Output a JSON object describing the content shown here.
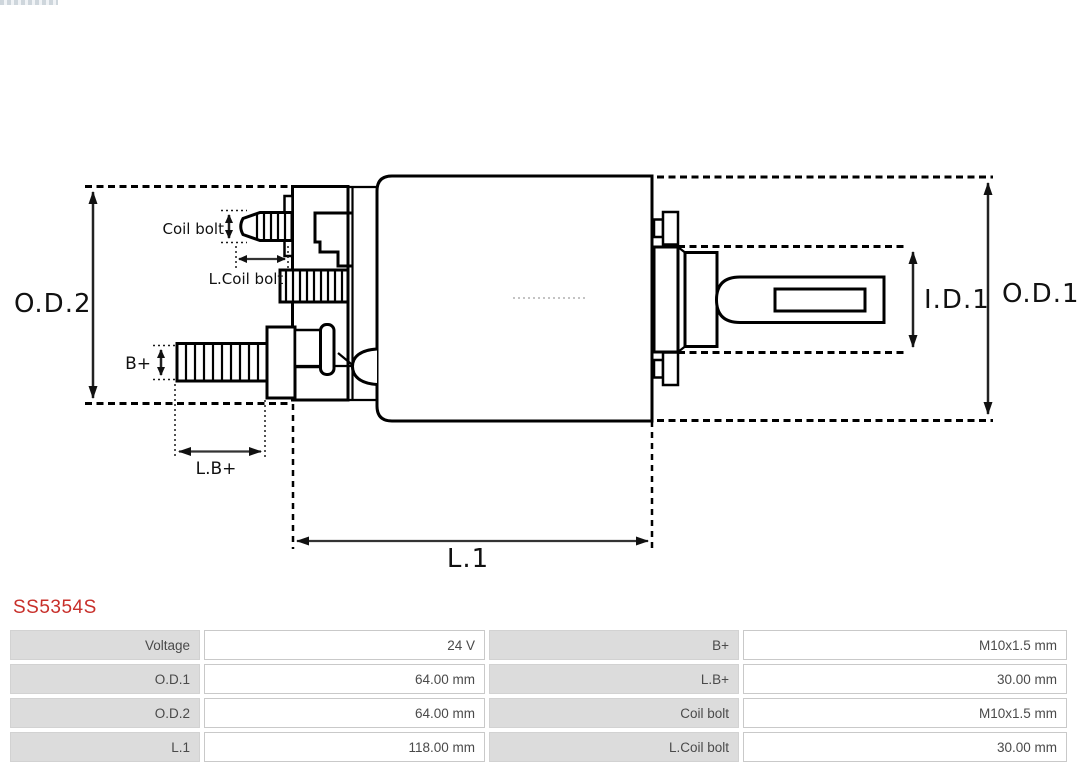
{
  "header": {
    "part_number": "SS5354S",
    "part_number_color": "#c8302b"
  },
  "diagram": {
    "type": "technical-drawing",
    "labels": {
      "od2": "O.D.2",
      "od1": "O.D.1",
      "id1": "I.D.1",
      "l1": "L.1",
      "coil_bolt": "Coil bolt",
      "l_coil_bolt": "L.Coil bolt",
      "b_plus": "B+",
      "l_b_plus": "L.B+"
    },
    "line_color": "#000000",
    "dim_line_color": "#333333"
  },
  "specs": {
    "label_bg": "#dcdcdc",
    "border_color": "#c9c9c9",
    "text_color": "#4a4a4a",
    "rows": [
      {
        "cells": [
          "Voltage",
          "24 V",
          "B+",
          "M10x1.5 mm"
        ]
      },
      {
        "cells": [
          "O.D.1",
          "64.00 mm",
          "L.B+",
          "30.00 mm"
        ]
      },
      {
        "cells": [
          "O.D.2",
          "64.00 mm",
          "Coil bolt",
          "M10x1.5 mm"
        ]
      },
      {
        "cells": [
          "L.1",
          "118.00 mm",
          "L.Coil bolt",
          "30.00 mm"
        ]
      }
    ]
  }
}
